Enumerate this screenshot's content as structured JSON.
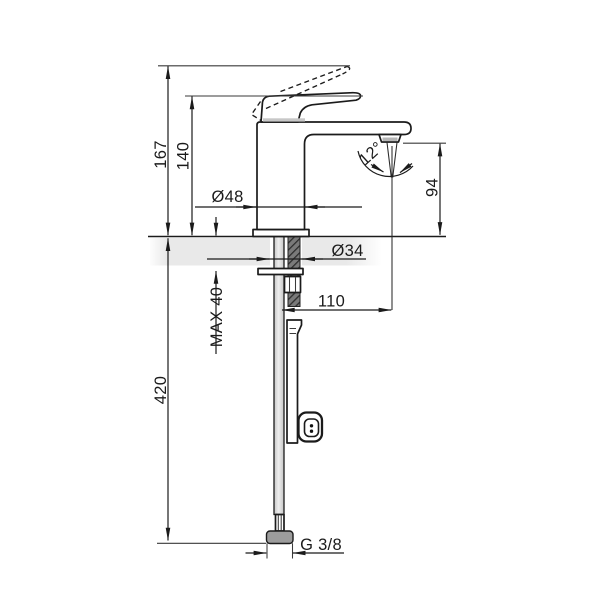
{
  "drawing": {
    "title": "Single-lever basin mixer faucet — side elevation installation drawing",
    "units": "mm",
    "dim": {
      "h167": "167",
      "h140": "140",
      "d48": "Ø48",
      "d34": "Ø34",
      "angle12": "12°",
      "h94": "94",
      "reach110": "110",
      "max40": "MAX 40",
      "h420": "420",
      "thread": "G 3/8"
    },
    "colors": {
      "line": "#1b1b1b",
      "countertop": "#e9e9e9",
      "hose": "#d4d4d4",
      "connector_nut": "#9c9c9c"
    }
  }
}
